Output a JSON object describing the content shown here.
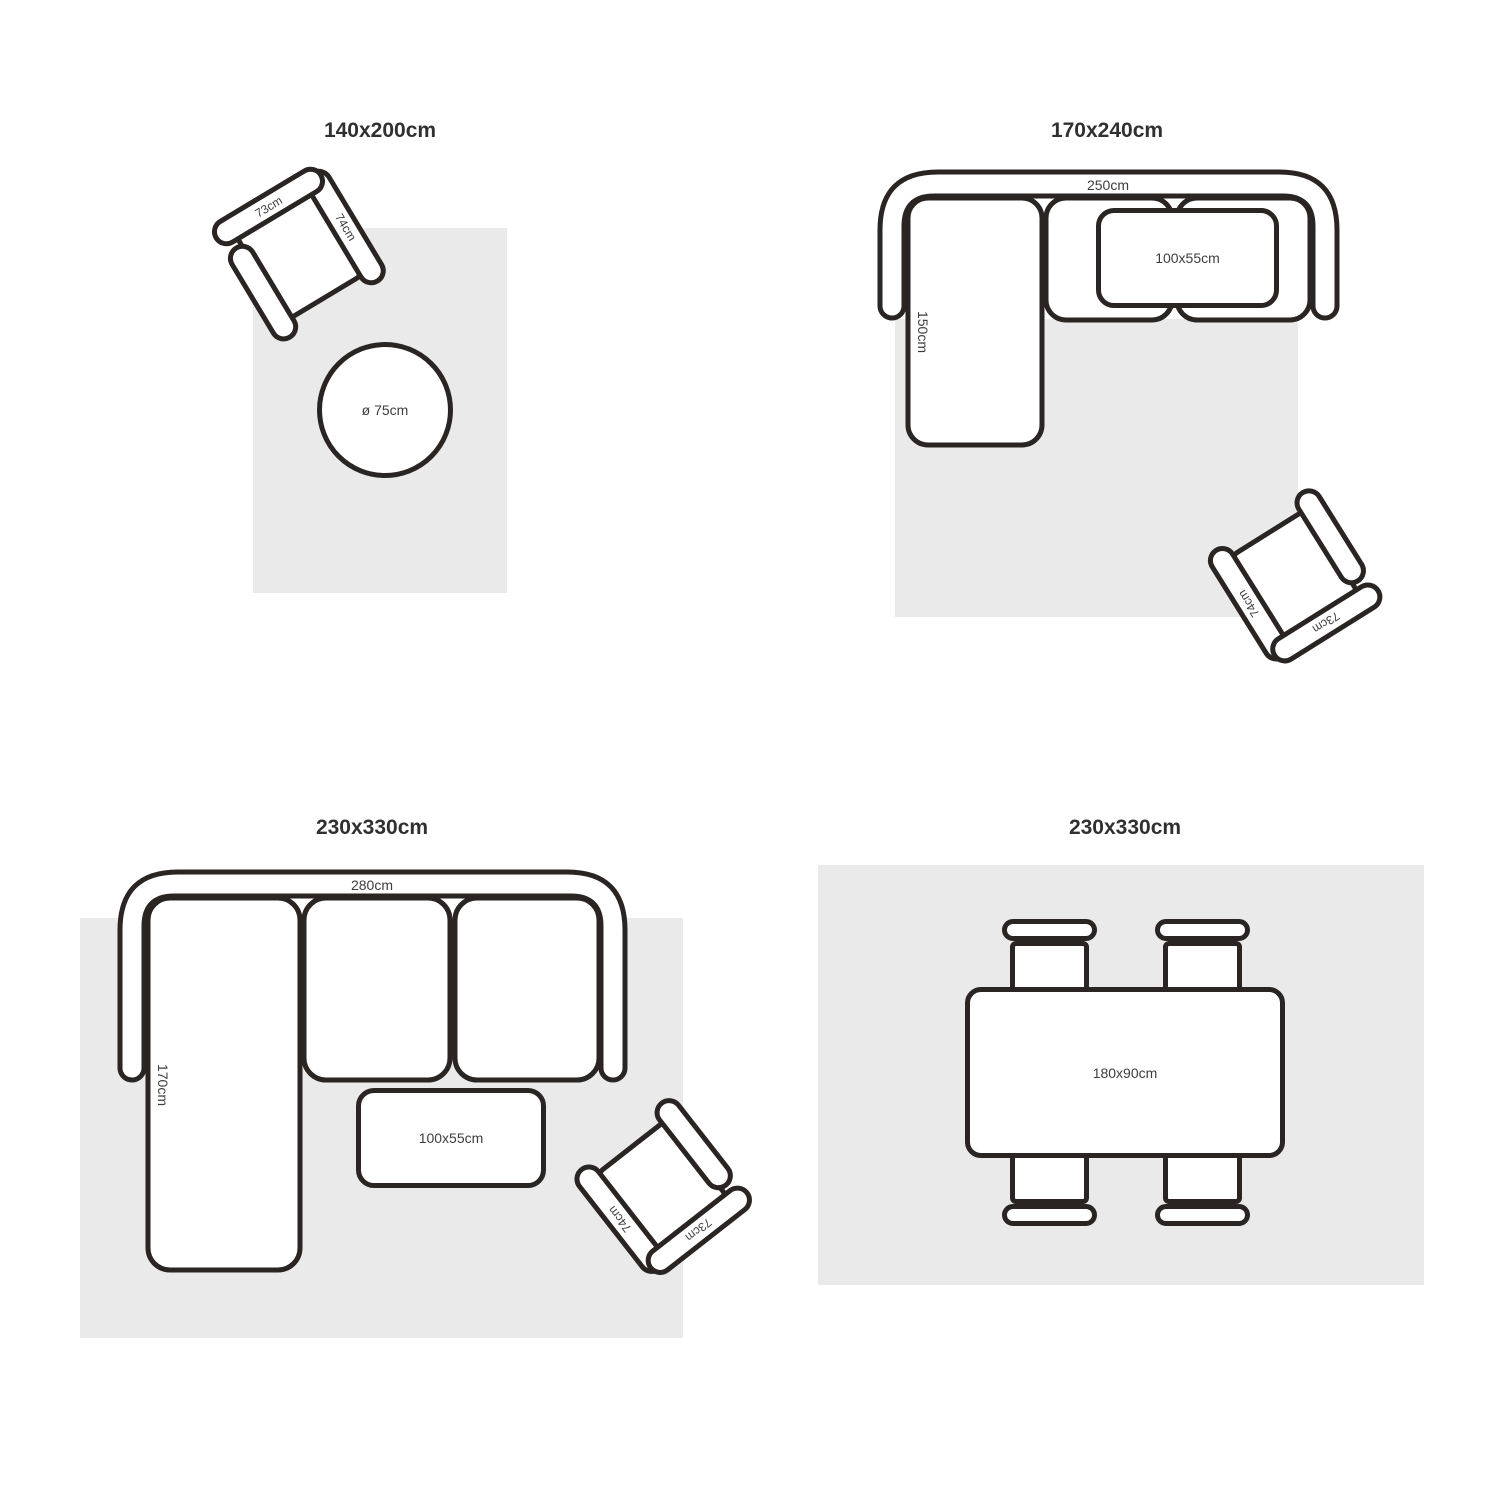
{
  "colors": {
    "background": "#ffffff",
    "outline": "#2a2522",
    "rug": "#eaeaea",
    "title_text": "#303030",
    "label_text": "#3d3d3d"
  },
  "quadrants": [
    {
      "id": "rug-140x200",
      "title": "140x200cm",
      "armchair": {
        "back_label": "73cm",
        "arm_label": "74cm"
      },
      "round_table_label": "ø 75cm"
    },
    {
      "id": "rug-170x240",
      "title": "170x240cm",
      "sofa": {
        "width_label": "250cm",
        "chaise_label": "150cm"
      },
      "coffee_table_label": "100x55cm",
      "armchair": {
        "back_label": "73cm",
        "arm_label": "74cm"
      }
    },
    {
      "id": "rug-230x330-sofa",
      "title": "230x330cm",
      "sofa": {
        "width_label": "280cm",
        "chaise_label": "170cm"
      },
      "coffee_table_label": "100x55cm",
      "armchair": {
        "back_label": "73cm",
        "arm_label": "74cm"
      }
    },
    {
      "id": "rug-230x330-dining",
      "title": "230x330cm",
      "dining_table_label": "180x90cm"
    }
  ]
}
